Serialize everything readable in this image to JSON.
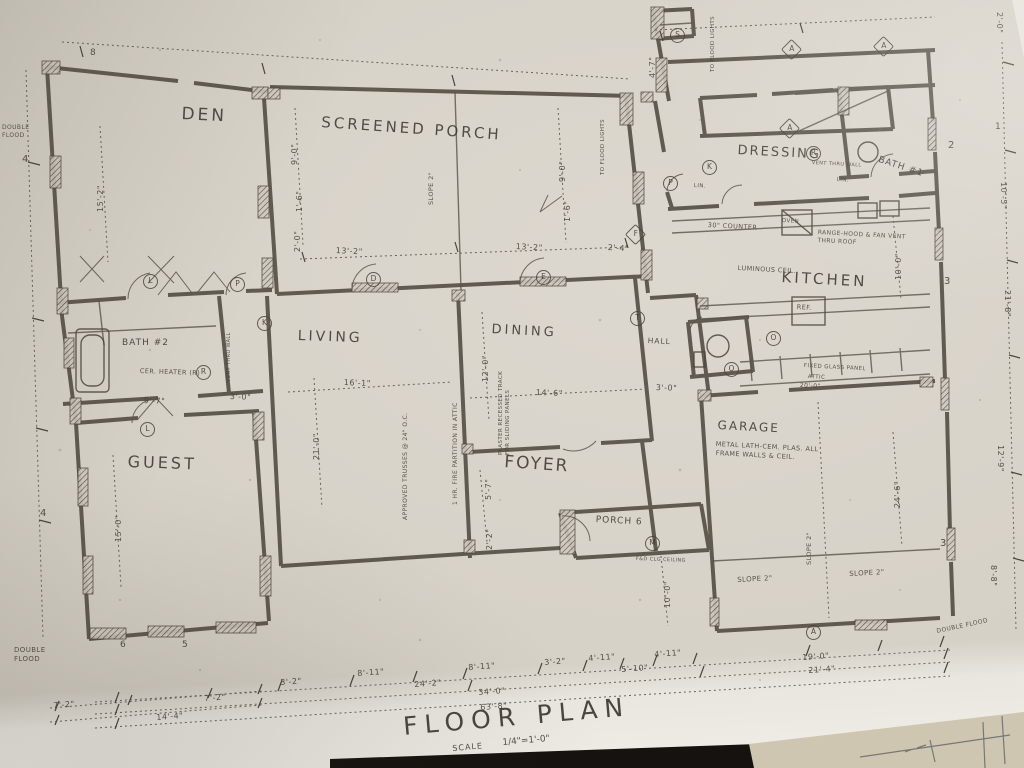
{
  "colors": {
    "paper": "#d6d1c7",
    "ink": "#3e3831",
    "table_black": "#15120f",
    "second_sheet": "#cfc6b1"
  },
  "title": {
    "name": "FLOOR PLAN",
    "scale_label": "SCALE",
    "scale_value": "1/4\"=1'-0\""
  },
  "rooms": {
    "den": "DEN",
    "screened_porch": "SCREENED PORCH",
    "dressing": "DRESSING",
    "bath1": "BATH #1",
    "kitchen": "KITCHEN",
    "living": "LIVING",
    "dining": "DINING",
    "guest": "GUEST",
    "bath2": "BATH #2",
    "foyer": "FOYER",
    "hall": "HALL",
    "garage": "GARAGE",
    "porch": "PORCH 6"
  },
  "dims": [
    "15'-2\"",
    "9'-0\"",
    "1'-6\"",
    "2'-0\"",
    "9'-0\"",
    "1'-6\"",
    "13'-2\"",
    "13'-2\"",
    "2'-4\"",
    "16'-1\"",
    "21'-0\"",
    "12'-0\"",
    "14'-6\"",
    "9'-7\"",
    "3'-0\"",
    "15'-0\"",
    "5'-7\"",
    "2'-2\"",
    "10'-0\"",
    "10'-0\"",
    "24'-6\"",
    "3'-0\"",
    "4'-7\"",
    "2'-0\"",
    "10'-5\"",
    "21'-8\"",
    "12'-9\"",
    "8'-8\"",
    "3'-2\"",
    "8'-11\"",
    "24'-2\"",
    "8'-11\"",
    "3'-2\"",
    "4'-11\"",
    "5'-10\"",
    "4'-11\"",
    "34'-0\"",
    "63'-8\"",
    "19'-0\"",
    "21'-4\"",
    "7'-2\"",
    "7'-2\"",
    "14'-4\"",
    "20'-0\""
  ],
  "notes": {
    "slope_porch": "SLOPE 2\"",
    "slope_garage1": "SLOPE 2\"",
    "slope_garage2": "SLOPE 2\"",
    "slope_garage_v": "SLOPE 2\"",
    "flood1": "TO FLOOD LIGHTS",
    "flood2": "TO FLOOD LIGHTS",
    "trusses": "APPROVED TRUSSES @ 24\" O.C.",
    "fire": "1 HR. FIRE PARTITION IN ATTIC",
    "plaster": "PLASTER RECESSED TRACK FOR SLIDING PANELS",
    "cer_heater": "CER. HEATER (R)",
    "vent_wall": "VENT THRU WALL",
    "vent_wall2": "VENT THRU WALL",
    "counter": "30\" COUNTER",
    "range": "RANGE-HOOD & FAN VENT THRU ROOF",
    "luminous": "LUMINOUS CEIL.",
    "ref": "REF.",
    "oven": "OVEN",
    "lin1": "LIN.",
    "lin2": "LIN.",
    "garage_note1": "METAL LATH-CEM. PLAS. ALL",
    "garage_note2": "FRAME WALLS & CEIL.",
    "glass": "FIXED GLASS PANEL",
    "attic": "ATTIC",
    "dbl_flood1": "DOUBLE FLOOD",
    "dbl_flood2": "DOUBLE FLOOD",
    "dbl_flood3": "DOUBLE FLOOD",
    "clg": "F&D CLG CEILING"
  },
  "markers": [
    "L",
    "P",
    "D",
    "E",
    "F",
    "P",
    "K",
    "T",
    "M",
    "A",
    "A",
    "A",
    "R",
    "R",
    "S",
    "L",
    "K",
    "O",
    "O",
    "A"
  ],
  "sections": [
    "8",
    "4",
    "4",
    "6",
    "5",
    "2",
    "3",
    "3",
    "1"
  ]
}
